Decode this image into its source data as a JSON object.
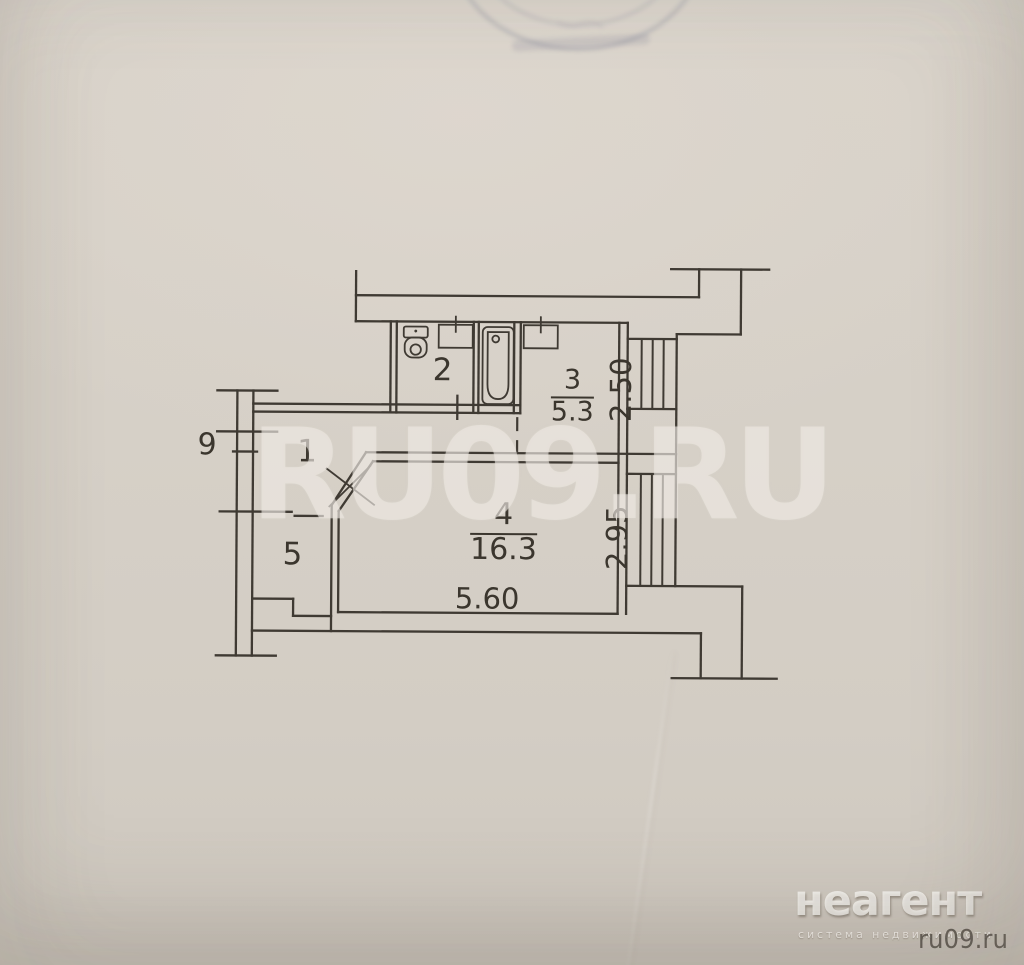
{
  "floorplan": {
    "rooms": {
      "r1": {
        "number": "1"
      },
      "r2": {
        "number": "2"
      },
      "r3": {
        "number": "3",
        "area": "5.3",
        "width_m": "2.50"
      },
      "r4": {
        "number": "4",
        "area": "16.3",
        "width_m": "2.95",
        "length_m": "5.60"
      },
      "r5": {
        "number": "5"
      }
    },
    "exterior_mark": "9",
    "fixtures": [
      "toilet-fixture",
      "washbasin-fixture",
      "bathtub-fixture",
      "kitchen-sink-fixture",
      "window-glazing",
      "door-open-mark"
    ]
  },
  "watermark": {
    "text": "RU09.RU"
  },
  "logo": {
    "brand": "неагент",
    "tagline": "система недвижимости",
    "site": "ru09.ru"
  },
  "colors": {
    "paper": "#d5cfc6",
    "ink": "#3f3a33",
    "watermark": "rgba(238,234,227,0.55)",
    "stamp": "rgba(108,112,138,0.38)"
  }
}
